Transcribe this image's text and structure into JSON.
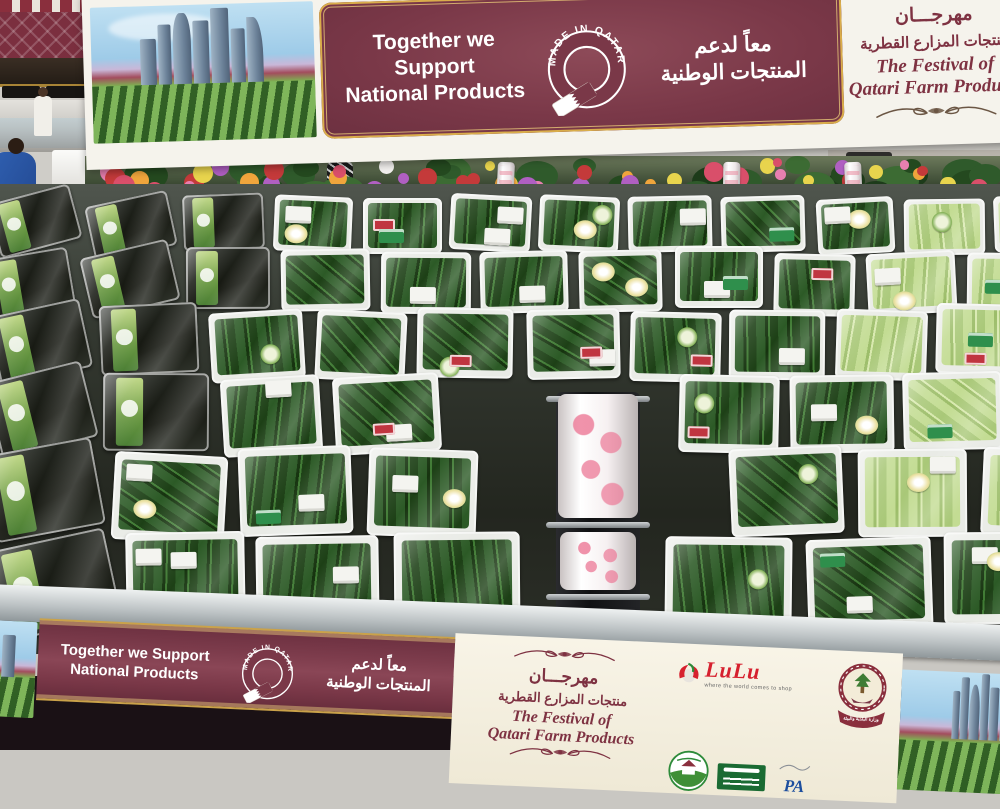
{
  "support_banner": {
    "english_line1": "Together we Support",
    "english_line2": "National Products",
    "arabic_line1": "معاً لدعم",
    "arabic_line2": "المنتجات الوطنية"
  },
  "made_in_qatar": "MADE IN QATAR",
  "festival": {
    "arabic_title": "مهرجـــان",
    "arabic_subtitle": "منتجات المزارع القطرية",
    "english_line1": "The Festival of",
    "english_line2": "Qatari Farm Products"
  },
  "logos": {
    "lulu_name": "LuLu",
    "lulu_tagline": "where the world comes to shop",
    "ministry_arabic": "وزارة البلدية والبيئة",
    "pa": "PA"
  },
  "palette": {
    "banner_maroon": "#7a3848",
    "gold": "#d9ad4b",
    "cream": "#f5f3ec",
    "festival_text": "#7e3242",
    "lulu_red": "#d6202e"
  },
  "scene": {
    "rows": [
      {
        "y": 196,
        "h": 56,
        "w": 80,
        "gap": 7
      },
      {
        "y": 250,
        "h": 62,
        "w": 86,
        "gap": 8
      },
      {
        "y": 308,
        "h": 70,
        "w": 93,
        "gap": 8
      },
      {
        "y": 374,
        "h": 78,
        "w": 102,
        "gap": 9
      },
      {
        "y": 450,
        "h": 88,
        "w": 112,
        "gap": 10
      },
      {
        "y": 536,
        "h": 92,
        "w": 122,
        "gap": 11
      }
    ],
    "tray": {
      "cuke_dark": [
        "#2c5a26",
        "#16330f",
        "#3f7a33",
        "#1d4016"
      ],
      "cuke_pale": [
        "#c3dc93",
        "#9cbd69",
        "#d8e9ae",
        "#a9c878"
      ],
      "dark_pack": [
        "#2a2e28",
        "#14160f",
        "#30342c"
      ]
    },
    "label_colors": {
      "white": "#f4f4f0",
      "green": "#2f8f4c",
      "red": "#c03540",
      "round_bg": "#eef3da",
      "gold": "#ece2a4"
    },
    "flowers": {
      "foliage_count": 36,
      "bloom_count": 46,
      "foliage_colors": [
        "#2f5a2b",
        "#24491f",
        "#3c6b33",
        "#1d3b1a"
      ],
      "bloom_colors": [
        "#e8d44d",
        "#f2f0ee",
        "#d94f6a",
        "#e77fb0",
        "#c43a3a",
        "#f0a53c",
        "#b05fc2"
      ]
    },
    "bag_rolls": [
      412,
      638,
      760
    ],
    "crate_stacks": [
      70,
      118,
      152
    ]
  }
}
